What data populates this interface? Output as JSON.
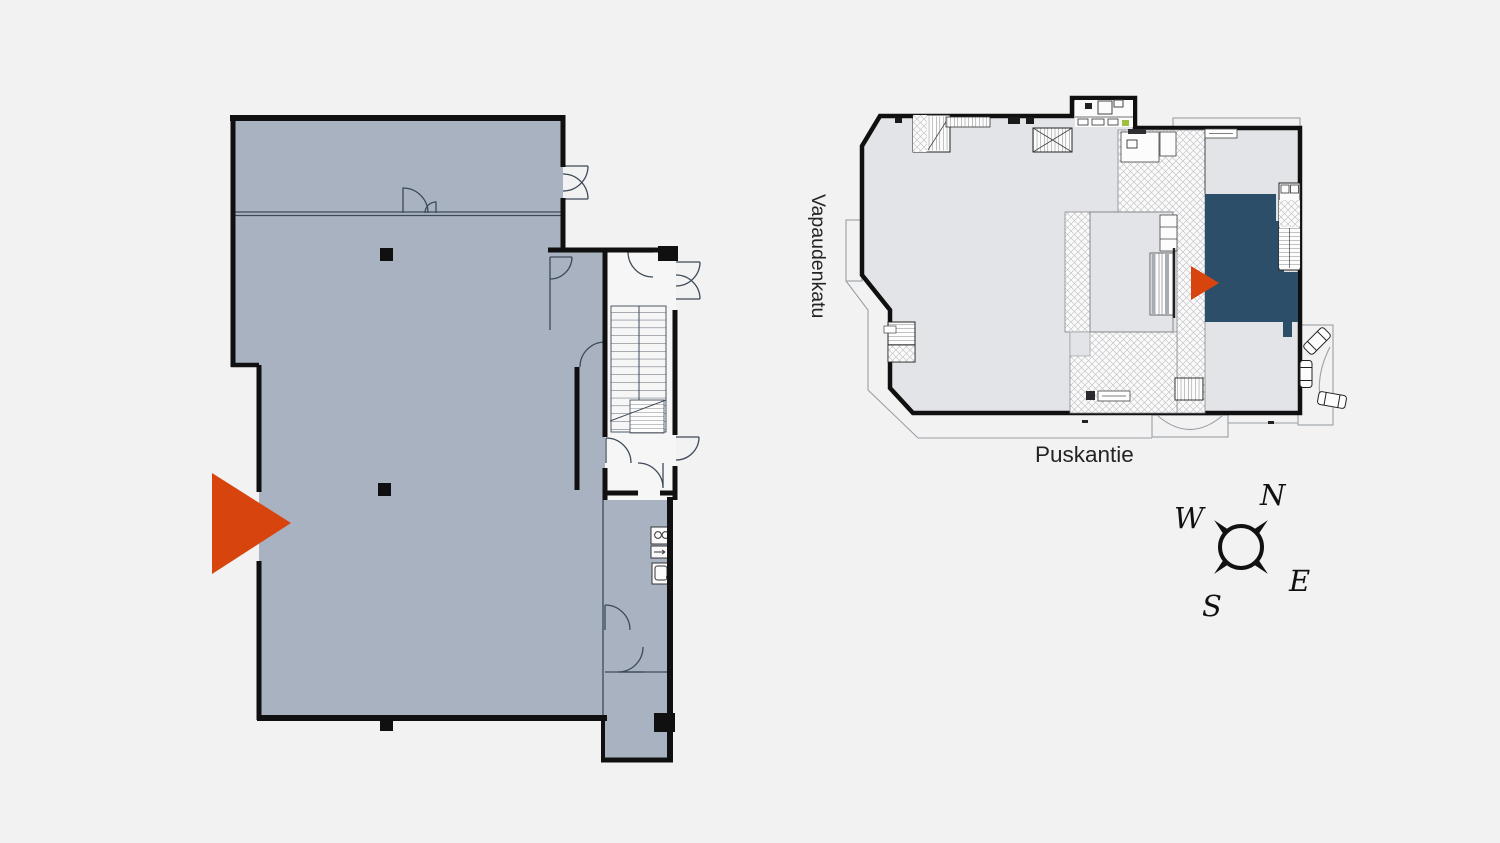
{
  "page": {
    "background_color": "#f2f2f3",
    "description_labels": {
      "street_left": "Vapaudenkatu",
      "street_bottom": "Puskantie"
    }
  },
  "left_plan": {
    "kind": "apartment-floorplan",
    "fill_color": "#a8b2c0",
    "wall_color": "#101010",
    "marker_color": "#d8440d"
  },
  "right_plan": {
    "kind": "building-siteplan",
    "fill_color": "#e2e4e8",
    "highlight_unit_color": "#2d4e68",
    "marker_color": "#d8440d",
    "street_left": "Vapaudenkatu",
    "street_bottom": "Puskantie"
  },
  "compass": {
    "n": "N",
    "w": "W",
    "e": "E",
    "s": "S"
  }
}
